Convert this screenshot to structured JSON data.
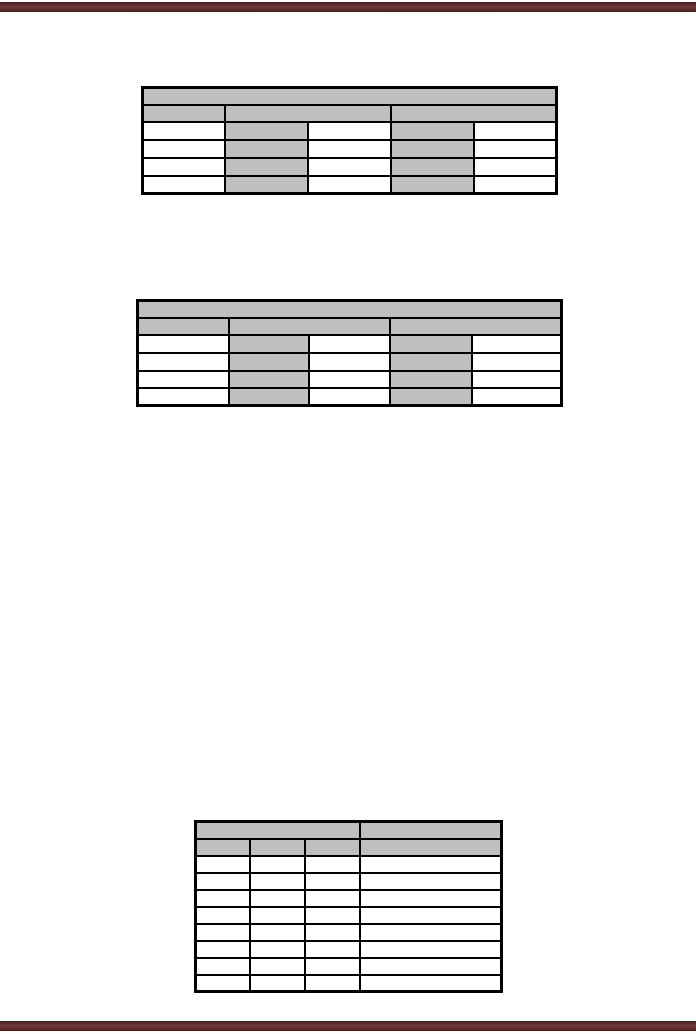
{
  "page": {
    "background_color": "#ffffff",
    "accent_bar_color": "#5e2524",
    "cell_shading_color": "#bfbfbf",
    "table_border_color": "#000000",
    "visible_text": ""
  },
  "tables": [
    {
      "name": "empty-table-1",
      "left": 141,
      "top": 86,
      "width": 414,
      "col_widths": [
        82,
        83,
        83,
        83,
        83
      ],
      "rows": [
        {
          "height": 17,
          "cells": [
            {
              "span": 5,
              "fill": "shaded",
              "text": ""
            }
          ]
        },
        {
          "height": 17,
          "cells": [
            {
              "span": 1,
              "fill": "shaded",
              "text": ""
            },
            {
              "span": 2,
              "fill": "shaded",
              "text": ""
            },
            {
              "span": 2,
              "fill": "shaded",
              "text": ""
            }
          ]
        },
        {
          "height": 18,
          "cells": [
            {
              "span": 1,
              "fill": "plain",
              "text": ""
            },
            {
              "span": 1,
              "fill": "shaded",
              "text": ""
            },
            {
              "span": 1,
              "fill": "plain",
              "text": ""
            },
            {
              "span": 1,
              "fill": "shaded",
              "text": ""
            },
            {
              "span": 1,
              "fill": "plain",
              "text": ""
            }
          ]
        },
        {
          "height": 18,
          "cells": [
            {
              "span": 1,
              "fill": "plain",
              "text": ""
            },
            {
              "span": 1,
              "fill": "shaded",
              "text": ""
            },
            {
              "span": 1,
              "fill": "plain",
              "text": ""
            },
            {
              "span": 1,
              "fill": "shaded",
              "text": ""
            },
            {
              "span": 1,
              "fill": "plain",
              "text": ""
            }
          ]
        },
        {
          "height": 18,
          "cells": [
            {
              "span": 1,
              "fill": "plain",
              "text": ""
            },
            {
              "span": 1,
              "fill": "shaded",
              "text": ""
            },
            {
              "span": 1,
              "fill": "plain",
              "text": ""
            },
            {
              "span": 1,
              "fill": "shaded",
              "text": ""
            },
            {
              "span": 1,
              "fill": "plain",
              "text": ""
            }
          ]
        },
        {
          "height": 18,
          "cells": [
            {
              "span": 1,
              "fill": "plain",
              "text": ""
            },
            {
              "span": 1,
              "fill": "shaded",
              "text": ""
            },
            {
              "span": 1,
              "fill": "plain",
              "text": ""
            },
            {
              "span": 1,
              "fill": "shaded",
              "text": ""
            },
            {
              "span": 1,
              "fill": "plain",
              "text": ""
            }
          ]
        }
      ]
    },
    {
      "name": "empty-table-2",
      "left": 136,
      "top": 299,
      "width": 424,
      "col_widths": [
        91,
        80,
        81,
        82,
        90
      ],
      "rows": [
        {
          "height": 17,
          "cells": [
            {
              "span": 5,
              "fill": "shaded",
              "text": ""
            }
          ]
        },
        {
          "height": 17,
          "cells": [
            {
              "span": 1,
              "fill": "shaded",
              "text": ""
            },
            {
              "span": 2,
              "fill": "shaded",
              "text": ""
            },
            {
              "span": 2,
              "fill": "shaded",
              "text": ""
            }
          ]
        },
        {
          "height": 18,
          "cells": [
            {
              "span": 1,
              "fill": "plain",
              "text": ""
            },
            {
              "span": 1,
              "fill": "shaded",
              "text": ""
            },
            {
              "span": 1,
              "fill": "plain",
              "text": ""
            },
            {
              "span": 1,
              "fill": "shaded",
              "text": ""
            },
            {
              "span": 1,
              "fill": "plain",
              "text": ""
            }
          ]
        },
        {
          "height": 18,
          "cells": [
            {
              "span": 1,
              "fill": "plain",
              "text": ""
            },
            {
              "span": 1,
              "fill": "shaded",
              "text": ""
            },
            {
              "span": 1,
              "fill": "plain",
              "text": ""
            },
            {
              "span": 1,
              "fill": "shaded",
              "text": ""
            },
            {
              "span": 1,
              "fill": "plain",
              "text": ""
            }
          ]
        },
        {
          "height": 17,
          "cells": [
            {
              "span": 1,
              "fill": "plain",
              "text": ""
            },
            {
              "span": 1,
              "fill": "shaded",
              "text": ""
            },
            {
              "span": 1,
              "fill": "plain",
              "text": ""
            },
            {
              "span": 1,
              "fill": "shaded",
              "text": ""
            },
            {
              "span": 1,
              "fill": "plain",
              "text": ""
            }
          ]
        },
        {
          "height": 18,
          "cells": [
            {
              "span": 1,
              "fill": "plain",
              "text": ""
            },
            {
              "span": 1,
              "fill": "shaded",
              "text": ""
            },
            {
              "span": 1,
              "fill": "plain",
              "text": ""
            },
            {
              "span": 1,
              "fill": "shaded",
              "text": ""
            },
            {
              "span": 1,
              "fill": "plain",
              "text": ""
            }
          ]
        }
      ]
    },
    {
      "name": "empty-table-3",
      "left": 194,
      "top": 820,
      "width": 306,
      "col_widths": [
        54,
        55,
        55,
        142
      ],
      "rows": [
        {
          "height": 17,
          "cells": [
            {
              "span": 3,
              "fill": "shaded",
              "text": ""
            },
            {
              "span": 1,
              "fill": "shaded",
              "text": ""
            }
          ]
        },
        {
          "height": 17,
          "cells": [
            {
              "span": 1,
              "fill": "shaded",
              "text": ""
            },
            {
              "span": 1,
              "fill": "shaded",
              "text": ""
            },
            {
              "span": 1,
              "fill": "shaded",
              "text": ""
            },
            {
              "span": 1,
              "fill": "shaded",
              "text": ""
            }
          ]
        },
        {
          "height": 17,
          "cells": [
            {
              "span": 1,
              "fill": "plain",
              "text": ""
            },
            {
              "span": 1,
              "fill": "plain",
              "text": ""
            },
            {
              "span": 1,
              "fill": "plain",
              "text": ""
            },
            {
              "span": 1,
              "fill": "plain",
              "text": ""
            }
          ]
        },
        {
          "height": 17,
          "cells": [
            {
              "span": 1,
              "fill": "plain",
              "text": ""
            },
            {
              "span": 1,
              "fill": "plain",
              "text": ""
            },
            {
              "span": 1,
              "fill": "plain",
              "text": ""
            },
            {
              "span": 1,
              "fill": "plain",
              "text": ""
            }
          ]
        },
        {
          "height": 17,
          "cells": [
            {
              "span": 1,
              "fill": "plain",
              "text": ""
            },
            {
              "span": 1,
              "fill": "plain",
              "text": ""
            },
            {
              "span": 1,
              "fill": "plain",
              "text": ""
            },
            {
              "span": 1,
              "fill": "plain",
              "text": ""
            }
          ]
        },
        {
          "height": 17,
          "cells": [
            {
              "span": 1,
              "fill": "plain",
              "text": ""
            },
            {
              "span": 1,
              "fill": "plain",
              "text": ""
            },
            {
              "span": 1,
              "fill": "plain",
              "text": ""
            },
            {
              "span": 1,
              "fill": "plain",
              "text": ""
            }
          ]
        },
        {
          "height": 17,
          "cells": [
            {
              "span": 1,
              "fill": "plain",
              "text": ""
            },
            {
              "span": 1,
              "fill": "plain",
              "text": ""
            },
            {
              "span": 1,
              "fill": "plain",
              "text": ""
            },
            {
              "span": 1,
              "fill": "plain",
              "text": ""
            }
          ]
        },
        {
          "height": 17,
          "cells": [
            {
              "span": 1,
              "fill": "plain",
              "text": ""
            },
            {
              "span": 1,
              "fill": "plain",
              "text": ""
            },
            {
              "span": 1,
              "fill": "plain",
              "text": ""
            },
            {
              "span": 1,
              "fill": "plain",
              "text": ""
            }
          ]
        },
        {
          "height": 17,
          "cells": [
            {
              "span": 1,
              "fill": "plain",
              "text": ""
            },
            {
              "span": 1,
              "fill": "plain",
              "text": ""
            },
            {
              "span": 1,
              "fill": "plain",
              "text": ""
            },
            {
              "span": 1,
              "fill": "plain",
              "text": ""
            }
          ]
        },
        {
          "height": 17,
          "cells": [
            {
              "span": 1,
              "fill": "plain",
              "text": ""
            },
            {
              "span": 1,
              "fill": "plain",
              "text": ""
            },
            {
              "span": 1,
              "fill": "plain",
              "text": ""
            },
            {
              "span": 1,
              "fill": "plain",
              "text": ""
            }
          ]
        }
      ]
    }
  ]
}
